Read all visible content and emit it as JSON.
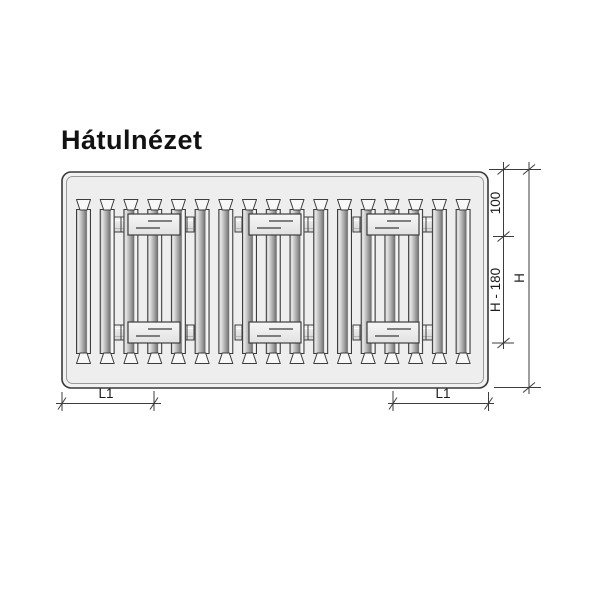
{
  "title": "Hátulnézet",
  "diagram": {
    "dims": {
      "top_offset": "100",
      "middle_span": "H - 180",
      "total_height": "H",
      "bracket_offset_left": "L1",
      "bracket_offset_right": "L1"
    },
    "colors": {
      "outline": "#3c3c3c",
      "panel_face": "#efefef",
      "panel_frame_fill": "#f2f2f2",
      "bracket_fill": "#e9e9e9",
      "background": "#ffffff"
    }
  }
}
